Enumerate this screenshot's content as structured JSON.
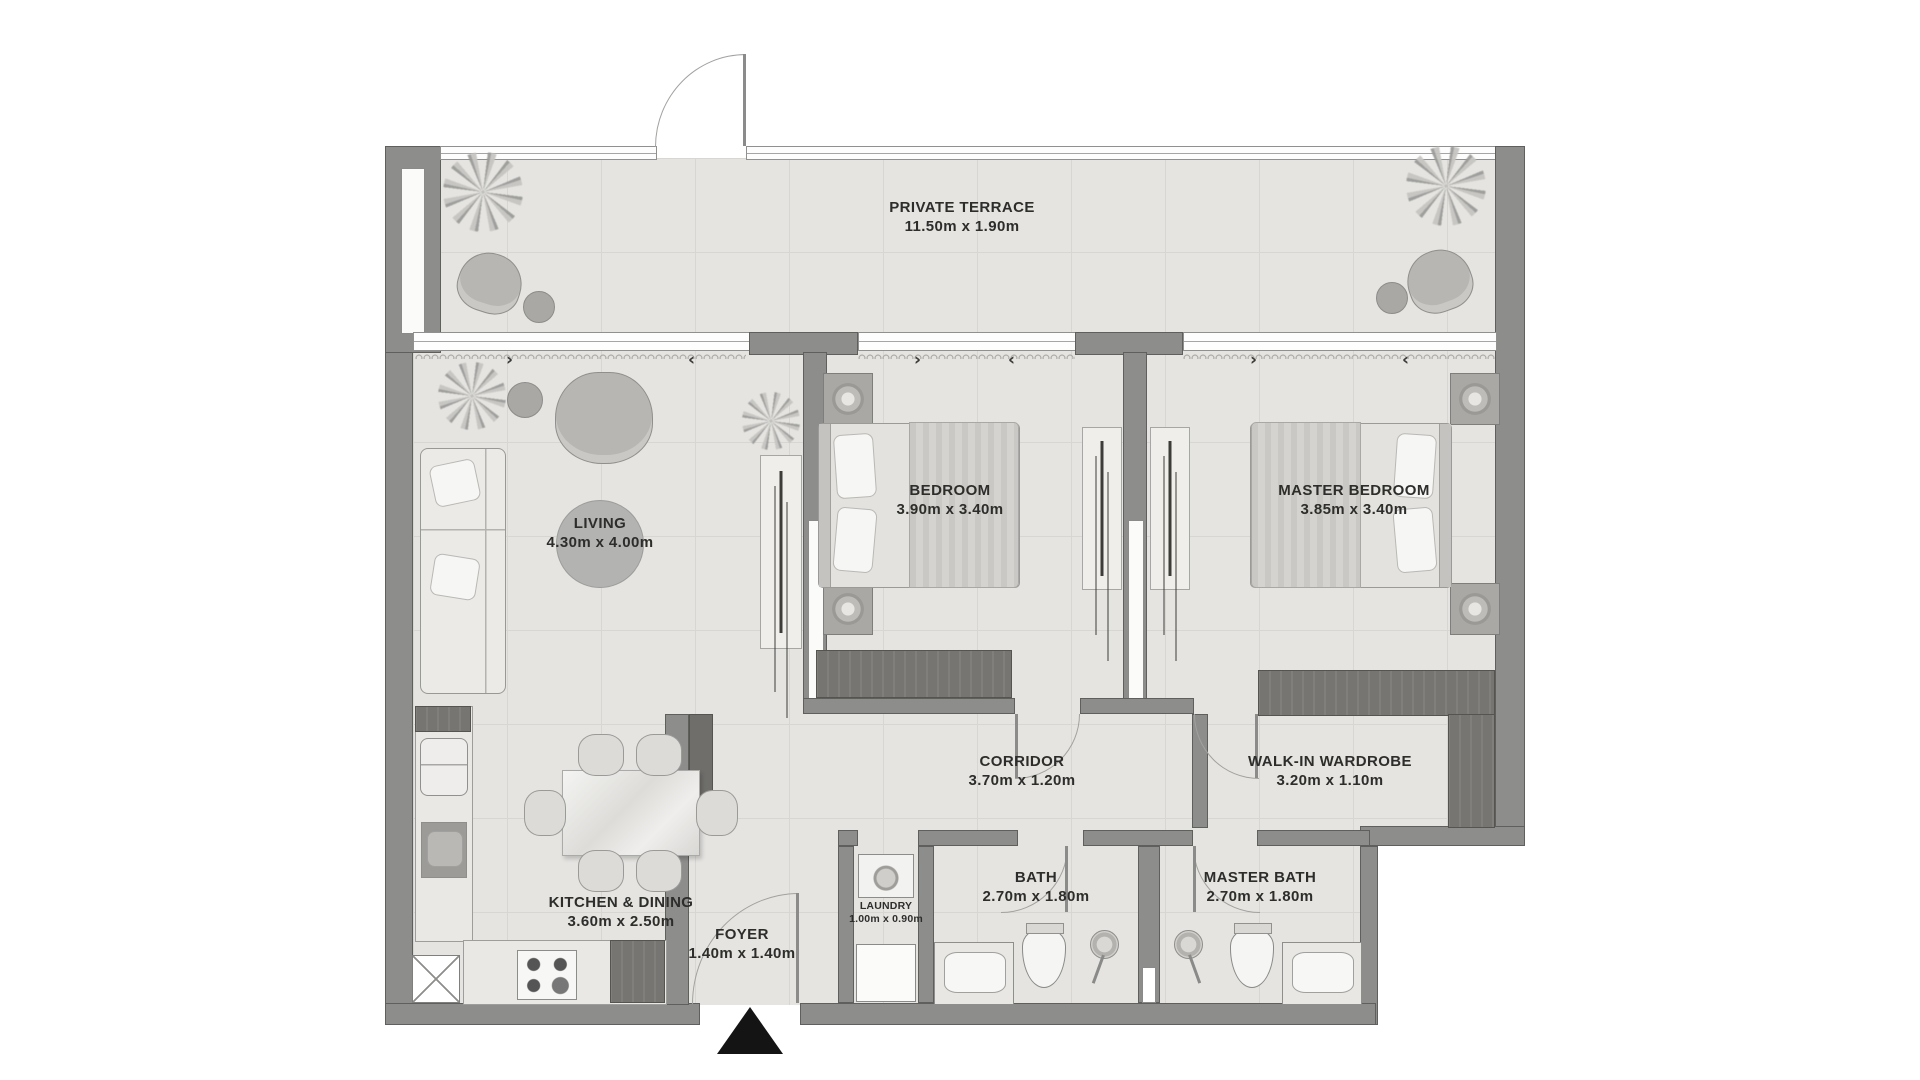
{
  "plan_title": "2 Bedroom Apartment Floor Plan",
  "colors": {
    "wall": "#8d8d8b",
    "wall_outline": "#5f5f5d",
    "floor": "#e5e4e1",
    "floor_grid_line": "#d7d6d3",
    "dark_unit": "#767572",
    "label_text": "#2d2d2b",
    "living_disc": "#b3b3b1",
    "entrance_marker": "#141414",
    "background": "#ffffff"
  },
  "icons": {
    "entrance_marker": "▲",
    "curtain_arrow_right": "›",
    "curtain_arrow_left": "‹",
    "plant": "starburst-plant",
    "shower": "shower-head",
    "toilet": "toilet",
    "sink": "wash-basin",
    "washer": "washing-machine",
    "stove": "four-burner-hob",
    "hanging_clothes": "wardrobe-rail"
  },
  "rooms": {
    "terrace": {
      "name": "PRIVATE TERRACE",
      "dims": "11.50m x 1.90m"
    },
    "living": {
      "name": "LIVING",
      "dims": "4.30m x 4.00m"
    },
    "bedroom": {
      "name": "BEDROOM",
      "dims": "3.90m x 3.40m"
    },
    "master_bedroom": {
      "name": "MASTER BEDROOM",
      "dims": "3.85m x 3.40m"
    },
    "corridor": {
      "name": "CORRIDOR",
      "dims": "3.70m x 1.20m"
    },
    "wardrobe": {
      "name": "WALK-IN WARDROBE",
      "dims": "3.20m x 1.10m"
    },
    "kitchen": {
      "name": "KITCHEN & DINING",
      "dims": "3.60m x 2.50m"
    },
    "foyer": {
      "name": "FOYER",
      "dims": "1.40m x 1.40m"
    },
    "laundry": {
      "name": "LAUNDRY",
      "dims": "1.00m x 0.90m"
    },
    "bath": {
      "name": "BATH",
      "dims": "2.70m x 1.80m"
    },
    "master_bath": {
      "name": "MASTER BATH",
      "dims": "2.70m x 1.80m"
    }
  }
}
